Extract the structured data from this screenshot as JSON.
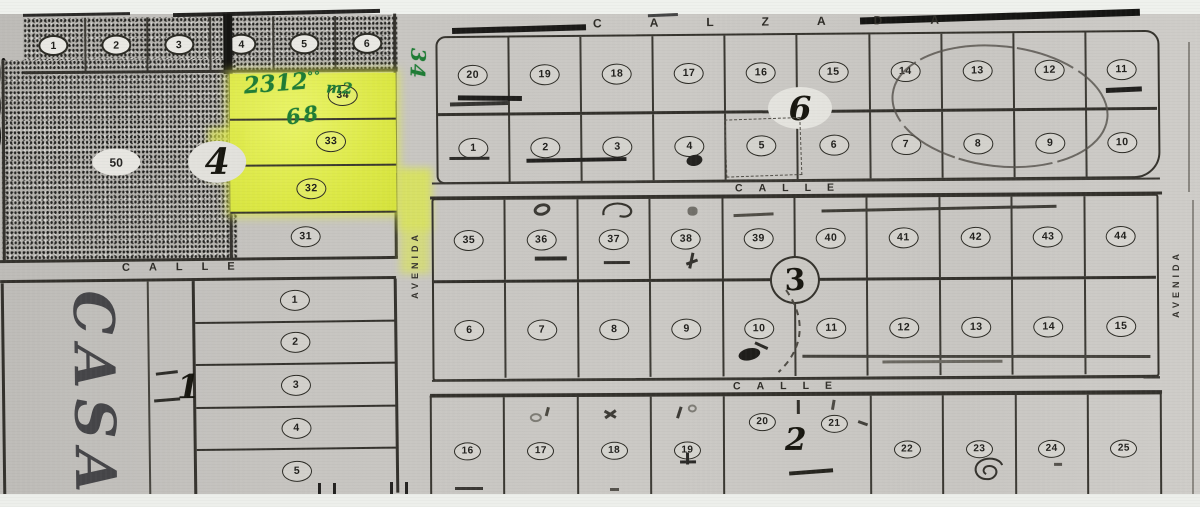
{
  "streets": {
    "calzada": "CALZADA",
    "calles": [
      "CALLE",
      "CALLE",
      "CALLE"
    ],
    "avenidas": [
      "AVENIDA",
      "AVENIDA"
    ]
  },
  "handwriting": {
    "area_value": "2312",
    "area_sup": "°°",
    "area_unit": "m2",
    "lot34_note": "68",
    "avenida_note": "34",
    "casa": "CASA"
  },
  "blocks": {
    "b4": {
      "label": "4",
      "big_lot": "50",
      "top_row": [
        "1",
        "2",
        "3",
        "4",
        "5",
        "6"
      ],
      "highlighted": [
        "34",
        "33",
        "32"
      ],
      "below_highlight": "31"
    },
    "b1": {
      "label": "1",
      "lots": [
        "1",
        "2",
        "3",
        "4",
        "5"
      ]
    },
    "b6": {
      "label": "6",
      "row_top": [
        "20",
        "19",
        "18",
        "17",
        "16",
        "15",
        "14",
        "13",
        "12",
        "11"
      ],
      "row_bottom": [
        "1",
        "2",
        "3",
        "4",
        "5",
        "6",
        "7",
        "8",
        "9",
        "10"
      ]
    },
    "b3": {
      "label": "3",
      "row_top": [
        "35",
        "36",
        "37",
        "38",
        "39",
        "40",
        "41",
        "42",
        "43",
        "44"
      ],
      "row_bottom": [
        "6",
        "7",
        "8",
        "9",
        "10",
        "11",
        "12",
        "13",
        "14",
        "15"
      ]
    },
    "b2": {
      "label": "2",
      "row_upper": [
        "20",
        "21"
      ],
      "row_lower_left": [
        "16",
        "17",
        "18",
        "19"
      ],
      "row_lower_right": [
        "22",
        "23",
        "24",
        "25"
      ]
    }
  },
  "colors": {
    "highlight": "#dde947",
    "ink_green": "#1f7c35",
    "paper": "#c7c5c1",
    "line": "#33312c"
  }
}
